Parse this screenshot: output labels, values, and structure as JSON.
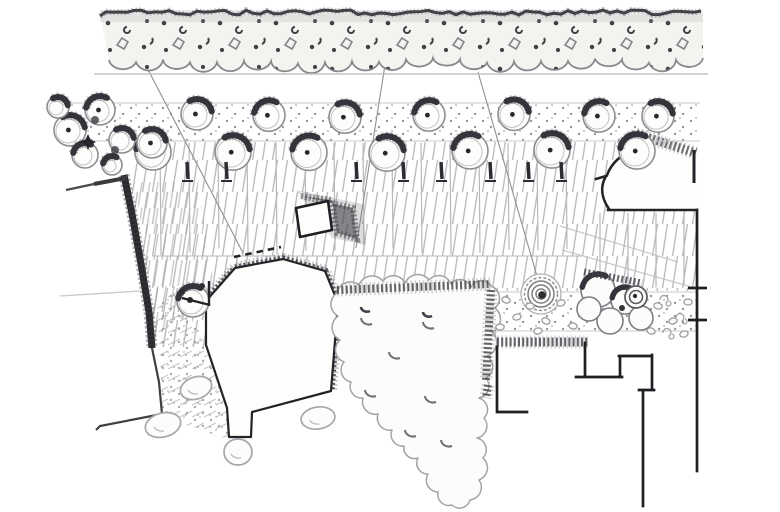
{
  "scene": {
    "label": "Hand-drawn pencil site plan sketch: hedge row, tree-lined stippled strip, hatched parking court, pentagonal building, kiosk, large tree canopy, walls and stepped site boundary",
    "background": "#ffffff"
  },
  "palette": {
    "paper": "#fdfdfb",
    "band_fill": "#f4f3f0",
    "faint": "#cdcdd1",
    "light": "#a9a9ae",
    "mid": "#84848a",
    "dark": "#3e3e44",
    "ink": "#232328",
    "hatch": "#bdbdc2",
    "leader": "#8f8f94"
  },
  "hedge": {
    "x1": 100,
    "x2": 703,
    "top": 10,
    "bottom": 58,
    "scallop": 27,
    "baseline": 74
  },
  "strips": [
    {
      "x": 58,
      "y": 103,
      "w": 640,
      "h": 38
    },
    {
      "x": 497,
      "y": 292,
      "w": 200,
      "h": 39
    }
  ],
  "strip_lines": [
    [
      58,
      103,
      700,
      103
    ],
    [
      58,
      141,
      700,
      141
    ],
    [
      497,
      292,
      697,
      292
    ],
    [
      497,
      331,
      697,
      331
    ]
  ],
  "faint_lines": [
    [
      94,
      74,
      708,
      74
    ],
    [
      152,
      256,
      582,
      256
    ],
    [
      60,
      296,
      140,
      291
    ],
    [
      560,
      226,
      678,
      262
    ],
    [
      562,
      250,
      695,
      288
    ]
  ],
  "leaders": [
    [
      142,
      58,
      243,
      253
    ],
    [
      388,
      46,
      356,
      248
    ],
    [
      478,
      72,
      541,
      290
    ]
  ],
  "stalls": {
    "main": {
      "y1": 143,
      "y2": 255,
      "xs": [
        160,
        189,
        218,
        247,
        276,
        305,
        334,
        363,
        392,
        421,
        450,
        479,
        508,
        537,
        566
      ]
    },
    "right": {
      "y1": 213,
      "y2": 289,
      "xs": [
        600,
        628,
        656,
        684
      ]
    }
  },
  "trees": {
    "upper": {
      "cy": 116,
      "r": 16,
      "xs": [
        197,
        269,
        345,
        429,
        514,
        599,
        658
      ]
    },
    "lower": {
      "cy": 152,
      "r": 18,
      "xs": [
        153,
        233,
        309,
        387,
        470,
        552,
        637
      ]
    }
  },
  "cluster": {
    "circles": [
      [
        70,
        130,
        16,
        "r"
      ],
      [
        100,
        110,
        15,
        "l"
      ],
      [
        122,
        140,
        13,
        "r"
      ],
      [
        85,
        155,
        13,
        "l"
      ],
      [
        58,
        107,
        11,
        "r"
      ],
      [
        112,
        165,
        10,
        "l"
      ]
    ],
    "star": [
      88,
      142
    ],
    "lone": [
      152,
      143,
      15
    ],
    "blobs": [
      [
        95,
        120
      ],
      [
        115,
        150
      ]
    ]
  },
  "corner_tree": {
    "c": [
      193,
      301,
      16
    ],
    "dot": [
      190,
      300
    ],
    "marks": [
      [
        202,
        286
      ],
      [
        182,
        292
      ]
    ]
  },
  "trunk_ticks": {
    "y1": 162,
    "y2": 179,
    "base": 181,
    "xs": [
      187,
      226,
      356,
      403,
      441,
      490,
      528,
      561
    ]
  },
  "pebbles": [
    [
      506,
      300,
      20
    ],
    [
      517,
      317,
      -15
    ],
    [
      530,
      306,
      0
    ],
    [
      546,
      321,
      25
    ],
    [
      561,
      303,
      -20
    ],
    [
      573,
      326,
      10
    ],
    [
      500,
      327,
      0
    ],
    [
      538,
      331,
      -10
    ],
    [
      658,
      306,
      15
    ],
    [
      673,
      321,
      -12
    ],
    [
      688,
      302,
      0
    ],
    [
      651,
      331,
      20
    ],
    [
      684,
      334,
      -18
    ]
  ],
  "stones": [
    [
      163,
      425,
      18,
      12,
      -15
    ],
    [
      196,
      388,
      16,
      11,
      -18
    ],
    [
      318,
      418,
      17,
      11,
      -8
    ],
    [
      238,
      452,
      14,
      13,
      0
    ]
  ],
  "spiral": [
    541,
    294
  ],
  "shrub": {
    "circles": [
      [
        598,
        290,
        17
      ],
      [
        625,
        300,
        14
      ],
      [
        641,
        318,
        12
      ],
      [
        610,
        321,
        13
      ],
      [
        589,
        309,
        12
      ]
    ],
    "ring": [
      636,
      297,
      11
    ],
    "curls": [
      [
        660,
        300
      ],
      [
        676,
        318
      ],
      [
        663,
        333
      ]
    ],
    "cap": [
      584,
      272,
      642,
      283
    ]
  },
  "courtyard_ticks": [
    [
      688,
      288,
      707,
      288
    ],
    [
      688,
      320,
      707,
      320
    ]
  ],
  "mass": {
    "points": [
      [
        337,
        293
      ],
      [
        359,
        285
      ],
      [
        383,
        281
      ],
      [
        405,
        283
      ],
      [
        429,
        280
      ],
      [
        451,
        284
      ],
      [
        471,
        287
      ],
      [
        491,
        286
      ],
      [
        495,
        308
      ],
      [
        492,
        332
      ],
      [
        487,
        356
      ],
      [
        486,
        378
      ],
      [
        479,
        398
      ],
      [
        484,
        418
      ],
      [
        477,
        438
      ],
      [
        483,
        458
      ],
      [
        479,
        480
      ],
      [
        470,
        500
      ],
      [
        452,
        505
      ],
      [
        438,
        492
      ],
      [
        428,
        474
      ],
      [
        418,
        458
      ],
      [
        404,
        446
      ],
      [
        392,
        430
      ],
      [
        378,
        414
      ],
      [
        363,
        398
      ],
      [
        351,
        382
      ],
      [
        344,
        362
      ],
      [
        340,
        340
      ],
      [
        338,
        316
      ]
    ],
    "crescents": [
      [
        368,
        318
      ],
      [
        430,
        322
      ],
      [
        396,
        352
      ],
      [
        372,
        390
      ],
      [
        432,
        396
      ],
      [
        412,
        430
      ],
      [
        448,
        440
      ]
    ],
    "dark_crescents": [
      [
        366,
        307
      ],
      [
        428,
        312
      ]
    ]
  },
  "dashed_line": [
    234,
    257,
    281,
    247
  ]
}
